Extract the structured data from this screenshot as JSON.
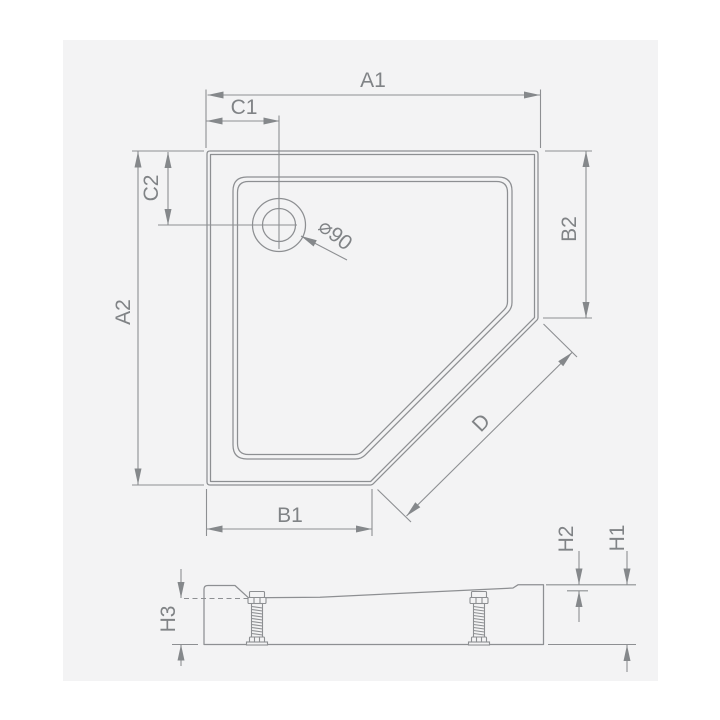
{
  "colors": {
    "page_bg": "#ffffff",
    "panel_bg": "#f3f3f4",
    "line": "#8d8f92",
    "text": "#808386"
  },
  "top_view": {
    "labels": {
      "a1": "A1",
      "c1": "C1",
      "c2": "C2",
      "a2": "A2",
      "b1": "B1",
      "b2": "B2",
      "d": "D",
      "drain_diameter": "⌀90"
    }
  },
  "side_view": {
    "labels": {
      "h1": "H1",
      "h2": "H2",
      "h3": "H3"
    }
  }
}
